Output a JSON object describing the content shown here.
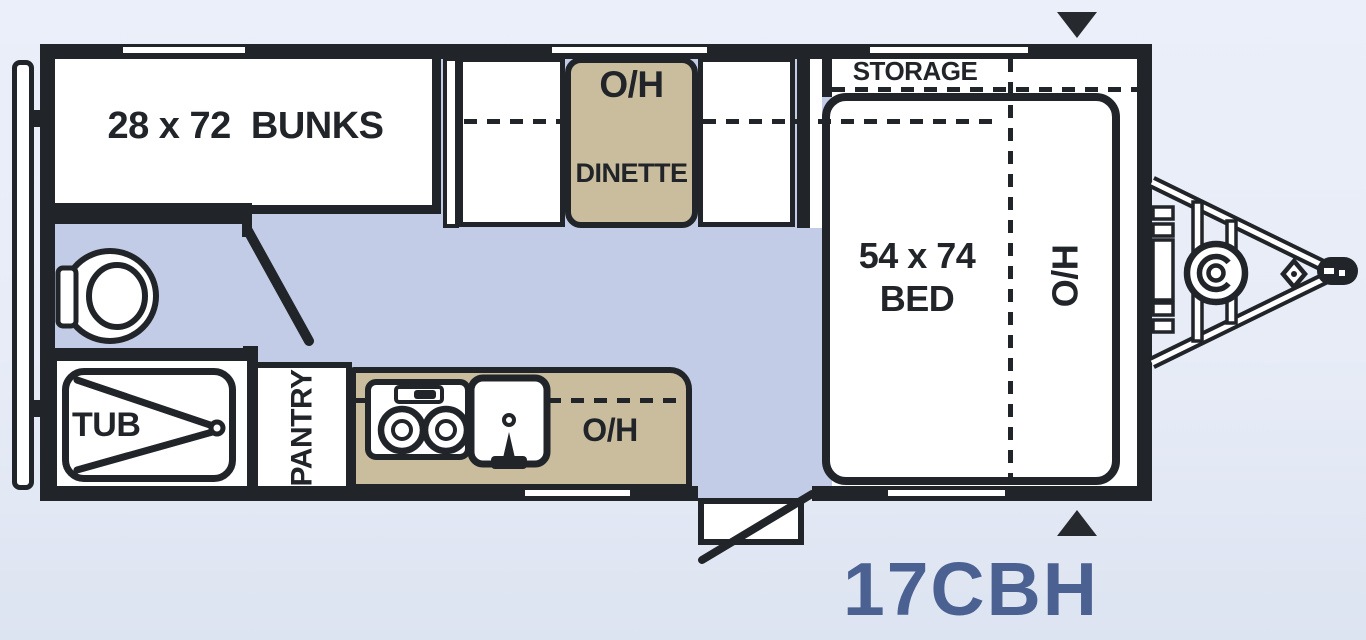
{
  "model_label": "17CBH",
  "colors": {
    "wall": "#212428",
    "floor": "#c2cce6",
    "furniture_tan": "#c9bd9e",
    "accent_blue": "#4a6191",
    "background": "#e9eef8",
    "room_white": "#ffffff"
  },
  "areas": {
    "bunks": {
      "label": "28 x 72  BUNKS"
    },
    "dinette": {
      "overhead_label": "O/H",
      "label": "DINETTE"
    },
    "storage": {
      "label": "STORAGE"
    },
    "bed": {
      "size_label": "54 x 74",
      "label": "BED",
      "overhead_label": "O/H"
    },
    "kitchen": {
      "overhead_label": "O/H"
    },
    "bathroom": {
      "tub_label": "TUB"
    },
    "pantry": {
      "label": "PANTRY"
    }
  },
  "icons": {
    "toilet": "toilet-icon",
    "tub_drain": "tub-drain-icon",
    "stove": "stove-icon",
    "sink": "sink-icon",
    "entry_door": "entry-door-swing-icon",
    "bathroom_door": "bathroom-door-swing-icon",
    "hitch": "tongue-hitch-icon",
    "propane_tank": "propane-tank-icon",
    "arrow_top": "arrow-down-icon",
    "arrow_bottom": "arrow-up-icon",
    "rear_bumper": "rear-bumper-icon"
  }
}
